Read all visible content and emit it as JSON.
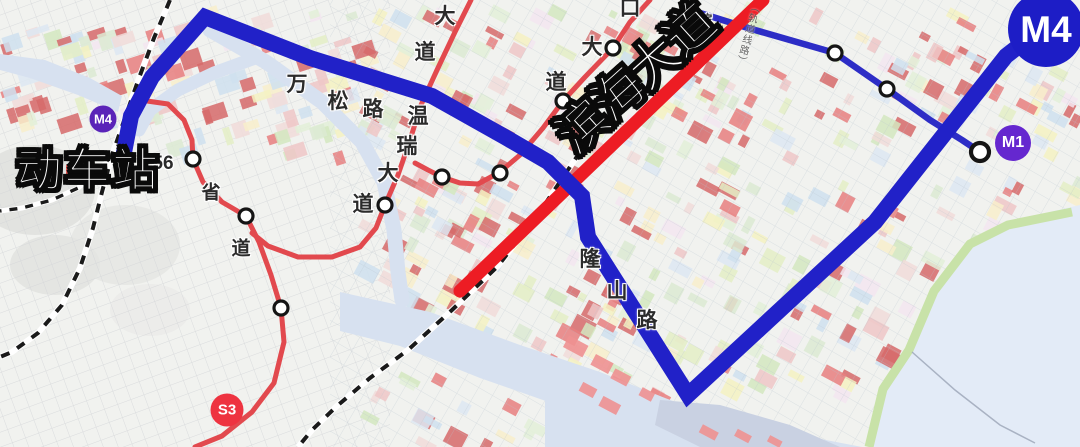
{
  "map": {
    "badges": {
      "m4_small": "M4",
      "m4_big": "M4",
      "m1": "M1",
      "s3": "S3"
    },
    "labels": {
      "station": "动车站",
      "avenue": "滨海大道",
      "railway_note": "（轨道线路）",
      "roads": [
        {
          "id": "dadao-n-1",
          "text": "大"
        },
        {
          "id": "dadao-n-2",
          "text": "道"
        },
        {
          "id": "wenrui-1",
          "text": "温"
        },
        {
          "id": "wenrui-2",
          "text": "瑞"
        },
        {
          "id": "wenrui-3",
          "text": "大"
        },
        {
          "id": "wenrui-4",
          "text": "道"
        },
        {
          "id": "wansong-1",
          "text": "万"
        },
        {
          "id": "wansong-2",
          "text": "松"
        },
        {
          "id": "wansong-3",
          "text": "路"
        },
        {
          "id": "koudadao-1",
          "text": "口"
        },
        {
          "id": "koudadao-2",
          "text": "大"
        },
        {
          "id": "koudadao-3",
          "text": "道"
        },
        {
          "id": "shengdao-1",
          "text": "省"
        },
        {
          "id": "shengdao-2",
          "text": "道"
        },
        {
          "id": "longshan-1",
          "text": "隆"
        },
        {
          "id": "longshan-2",
          "text": "山"
        },
        {
          "id": "longshan-3",
          "text": "路"
        },
        {
          "id": "route-number",
          "text": "56"
        },
        {
          "id": "bin-small",
          "text": "滨"
        }
      ]
    },
    "colors": {
      "m4_line": "#2121c8",
      "m1_line": "#2d2dc6",
      "avenue_red": "#ed1c24",
      "road_red": "#e2494e",
      "badge_purple": "#5a23b8",
      "badge_m1": "#6527cf",
      "badge_s3": "#ee3340",
      "badge_m4_big": "#1d1dc6",
      "water": "#d7e1f0",
      "sea": "#e3ebf7",
      "block_palette": [
        "#dcead2",
        "#e4efc6",
        "#f5f2c2",
        "#f8eecb",
        "#d4e8c0",
        "#f1dcd9",
        "#eec7c7",
        "#e87f7f",
        "#dde7f2",
        "#cfe0ef",
        "#f3e6f0",
        "#e3f0d8",
        "#d66a6a"
      ]
    }
  }
}
